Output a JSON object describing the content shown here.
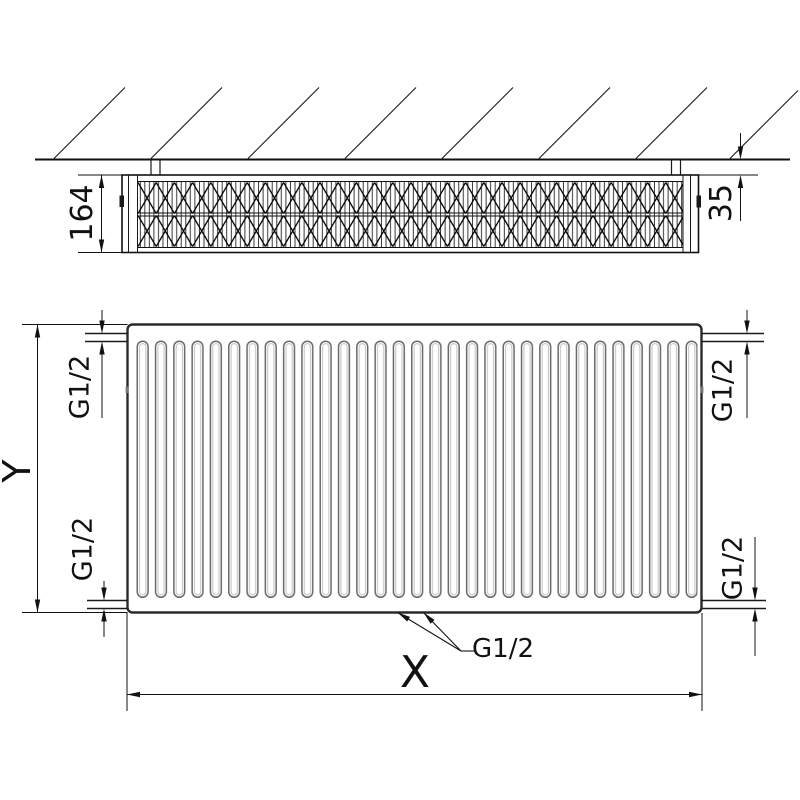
{
  "colors": {
    "background": "#ffffff",
    "line": "#1a1a1a",
    "fin_line": "#6a6a6a"
  },
  "top_view": {
    "depth_dim": "164",
    "wall_gap_dim": "35"
  },
  "front_view": {
    "height_dim": "Y",
    "width_dim": "X",
    "connections": {
      "top_left": "G1/2",
      "top_right": "G1/2",
      "bottom_left": "G1/2",
      "bottom_right": "G1/2",
      "bottom_center": "G1/2"
    }
  }
}
